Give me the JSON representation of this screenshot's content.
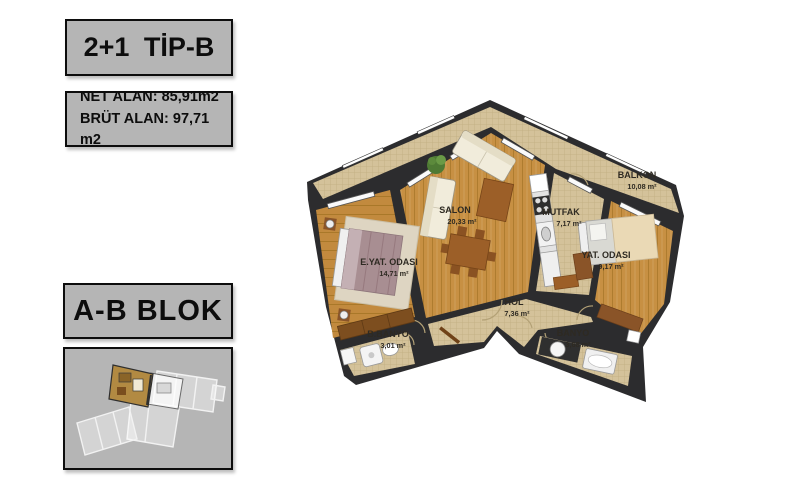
{
  "panel": {
    "type_label": "2+1 TİP-B",
    "net_alan": "NET ALAN: 85,91m2",
    "brut_alan": "BRÜT ALAN: 97,71 m2",
    "blok_label": "A-B BLOK"
  },
  "plan": {
    "rooms": [
      {
        "name": "SALON",
        "area": "20,33 m²"
      },
      {
        "name": "MUTFAK",
        "area": "7,17 m²"
      },
      {
        "name": "BALKON",
        "area": "10,08 m²"
      },
      {
        "name": "E.YAT. ODASI",
        "area": "14,71 m²"
      },
      {
        "name": "YAT. ODASI",
        "area": "9,17 m²"
      },
      {
        "name": "HOL",
        "area": "7,36 m²"
      },
      {
        "name": "B.BANYO",
        "area": "3,01 m²"
      },
      {
        "name": "BANYO",
        "area": "3,68 m²"
      }
    ],
    "colors": {
      "wall": "#2c2c2e",
      "wood_floor": "#c79043",
      "tile_floor": "#d4c29a",
      "panel_gray": "#b5b5b5",
      "highlight_unit": "#b28a42"
    }
  }
}
